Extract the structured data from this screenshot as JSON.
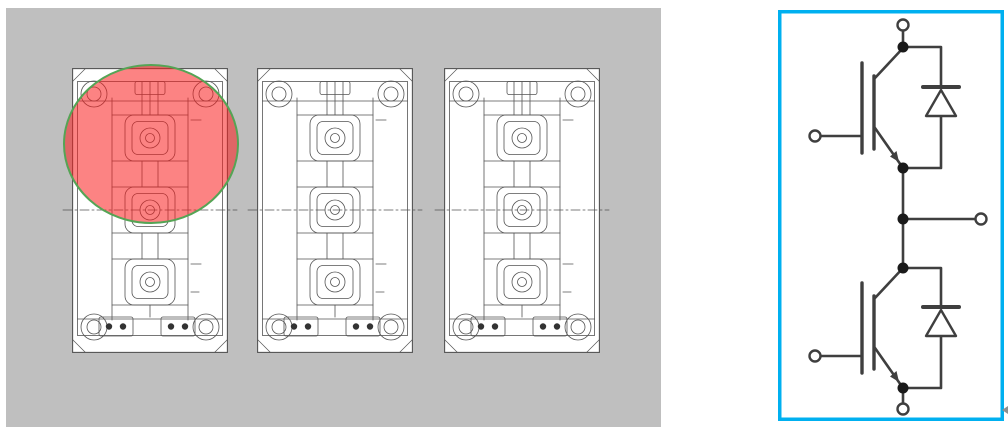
{
  "canvas": {
    "width": 1008,
    "height": 433,
    "background_color": "#ffffff"
  },
  "module_panel": {
    "background_color": "#bfbfbf",
    "line_color": "#545454",
    "module_fill_color": "#ffffff",
    "pin_dot_color": "#333333",
    "modules": [
      {
        "name": "igbt-module-drawing-1",
        "highlighted": true
      },
      {
        "name": "igbt-module-drawing-2",
        "highlighted": false
      },
      {
        "name": "igbt-module-drawing-3",
        "highlighted": false
      }
    ],
    "highlight": {
      "shape": "ellipse",
      "fill_color": "#fa1e1e",
      "fill_opacity": "0.55",
      "border_color": "#55a455",
      "location": "upper half of first module"
    }
  },
  "circuit_panel": {
    "border_color": "#00b0f0",
    "background_color": "#ffffff",
    "line_color": "#3f3f3f",
    "node_color": "#1a1a1a",
    "circuit_type": "IGBT half-bridge phase leg with anti-parallel diodes",
    "components": [
      {
        "name": "upper-igbt"
      },
      {
        "name": "upper-freewheel-diode"
      },
      {
        "name": "lower-igbt"
      },
      {
        "name": "lower-freewheel-diode"
      }
    ],
    "terminals": [
      {
        "name": "dc-plus-terminal"
      },
      {
        "name": "upper-gate-terminal"
      },
      {
        "name": "phase-output-terminal"
      },
      {
        "name": "lower-gate-terminal"
      },
      {
        "name": "dc-minus-terminal"
      }
    ]
  },
  "artifacts": {
    "stray_mark_color": "#8f8f8f"
  }
}
